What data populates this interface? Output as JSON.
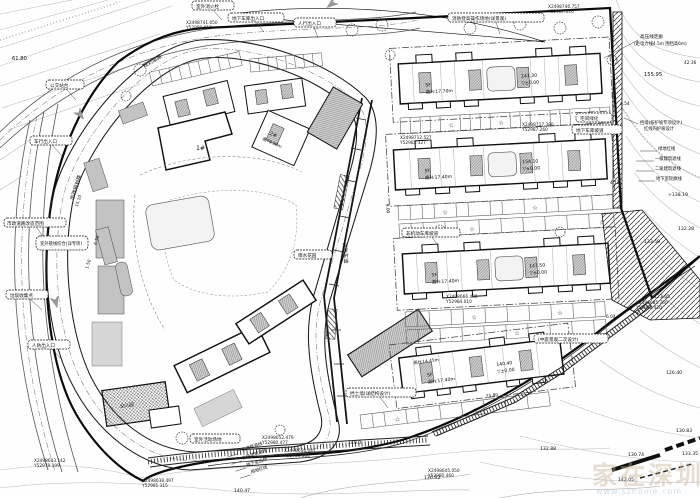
{
  "drawing": {
    "type": "site-plan",
    "ink_color": "#111111",
    "paper_color": "#fefefe"
  },
  "buildings": {
    "b1": {
      "floors": "5F",
      "height": "高H:17.70m",
      "elev": "141.30",
      "base": "▽±0.00"
    },
    "b2": {
      "floors": "5F",
      "height": "高H:17.40m",
      "elev": "154.10",
      "base": "▽±0.00"
    },
    "b3": {
      "floors": "5F",
      "height": "高H:17.40m",
      "elev": "147.50",
      "base": "▽±0.00"
    },
    "b4": {
      "floors": "5F",
      "height": "高H:17.40m",
      "elev": "140.40",
      "base": "▽±0.00",
      "annex": "高H:14.45m"
    },
    "tower2": {
      "name": "2#",
      "height": "高79.90m"
    },
    "cluster1": {
      "name": "1#"
    },
    "kindergarten": {
      "name": "幼儿园"
    }
  },
  "spots": [
    {
      "t": "61.80"
    },
    {
      "t": "155.95"
    },
    {
      "t": "42.36"
    },
    {
      "t": "+138.19"
    },
    {
      "t": "132.28"
    },
    {
      "t": "133.59"
    },
    {
      "t": "123.65"
    },
    {
      "t": "126.40"
    },
    {
      "t": "130.83"
    },
    {
      "t": "130.74"
    },
    {
      "t": "133.35"
    },
    {
      "t": "132.88"
    },
    {
      "t": "136.93"
    },
    {
      "t": "140.0"
    },
    {
      "t": "142.05"
    },
    {
      "t": "140.47"
    }
  ],
  "coords": [
    {
      "x": "X2498741.050",
      "y": "Y52980.010"
    },
    {
      "x": "X2498746.757",
      "y": "Y52987.110"
    },
    {
      "x": "X2498712.527",
      "y": "Y52983.327"
    },
    {
      "x": "X2498717.390",
      "y": "Y52987.260"
    },
    {
      "x": "X2498666.480",
      "y": "Y52984.010"
    },
    {
      "x": "X2498685.760",
      "y": "Y52985.420"
    },
    {
      "x": "X2498643.142",
      "y": "Y52979.109"
    },
    {
      "x": "X2498652.479",
      "y": "Y52980.477"
    },
    {
      "x": "X2498650.041",
      "y": "Y52980.304"
    },
    {
      "x": "X2498645.050",
      "y": "Y52980.460"
    },
    {
      "x": "X2498638.497",
      "y": "Y52981.315"
    }
  ],
  "tags": [
    "室外消火栓",
    "地下车库出入口",
    "人行出入口",
    "消防登高操作场地(详景观)",
    "公交站台",
    "车行出入口",
    "市政道路改造范围",
    "垃圾收集点",
    "人防出入口",
    "(中庭景观二次设计)",
    "非机动车库坡道",
    "挡土墙(详结构设计)",
    "室外活动场地",
    "宅间绿化",
    "地下车库坡道",
    "雨水花园",
    "室外管线综合(详专项)"
  ],
  "legend_right": [
    "绿地红线",
    "一级建筑退线",
    "二级建筑退线",
    "地下室轮廓线"
  ],
  "legend_bottom": [
    "一级建筑退线",
    "二级建筑退线",
    "地下室边线",
    "用地红线"
  ],
  "notes": {
    "hv1": "高压线走廊",
    "hv2": "(距电力线4.5m 围挡高6m)",
    "wall1": "挡墙(按护坡专项设计)",
    "wall2": "红线内护坡设计"
  },
  "streets": {
    "left": "市政规划路",
    "top": "规划道路",
    "diag": "消防车道"
  },
  "dims": [
    "6.50",
    "15.10",
    "25.80",
    "4.12",
    "6.04",
    "9.00",
    "1.50",
    "4.54"
  ],
  "symbols": {
    "star": "☆"
  },
  "watermark": {
    "cn": "家在深圳",
    "en": "www.szhome.com"
  }
}
